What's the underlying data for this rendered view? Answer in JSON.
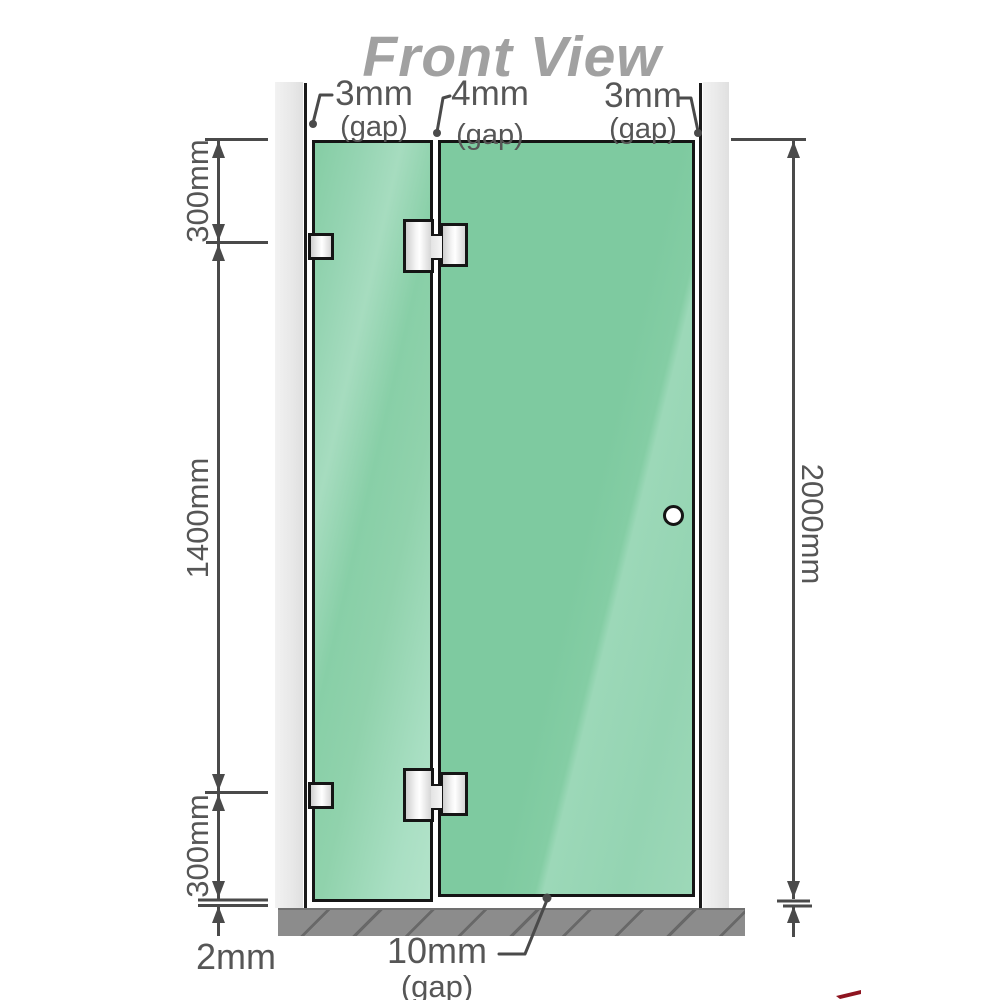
{
  "title": "Front View",
  "gap_annotations": {
    "top_left": {
      "value": "3mm",
      "unit": "(gap)"
    },
    "top_middle": {
      "value": "4mm",
      "unit": "(gap)"
    },
    "top_right": {
      "value": "3mm",
      "unit": "(gap)"
    },
    "bottom": {
      "value": "10mm",
      "unit": "(gap)"
    }
  },
  "dimensions": {
    "left_top": "300mm",
    "left_middle": "1400mm",
    "left_bottom": "300mm",
    "right_full": "2000mm",
    "floor_clearance": "2mm"
  },
  "components": {
    "left_wall": "wall post",
    "right_wall": "wall post",
    "fixed_panel": "fixed glass panel",
    "door_panel": "hinged glass door panel",
    "glass_hinges": "2 glass-to-glass hinges",
    "wall_brackets": "2 wall-to-glass brackets",
    "door_handle": "round knob handle",
    "floor_base": "hatched floor strip"
  },
  "colors": {
    "glass_green": "#80cba1",
    "glass_highlight": "#a7ddc2",
    "wall_gray": "#ececec",
    "base_gray": "#8c8c8c",
    "dimension_lines": "#4a4a4a",
    "annotation_text": "#565656",
    "title_text": "#a1a1a1",
    "hardware_silver": "#ededed",
    "outline_black": "#151515",
    "corner_accent_red": "#8e1420"
  }
}
